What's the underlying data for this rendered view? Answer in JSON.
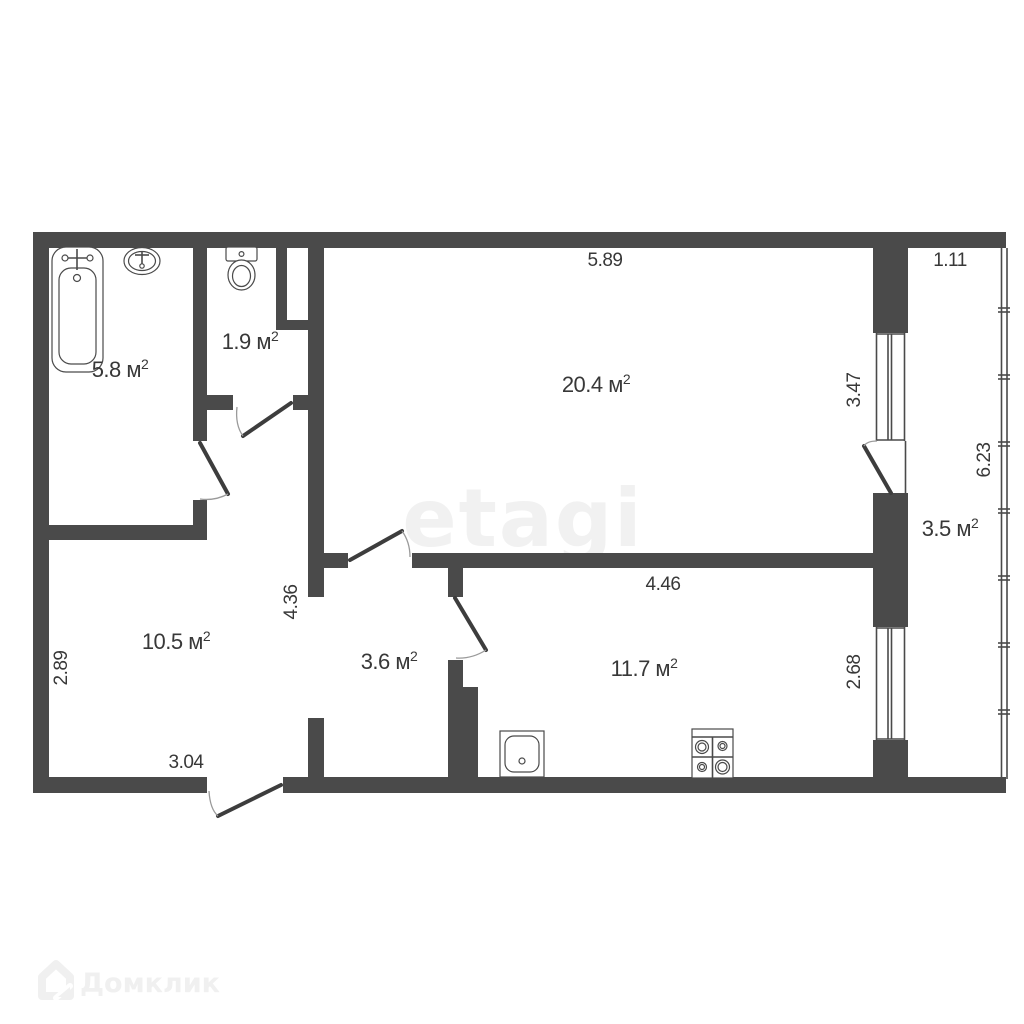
{
  "watermarks": {
    "brand_center": "etagi",
    "brand_bottom": "Домклик"
  },
  "rooms": [
    {
      "id": "bathroom",
      "area_label": "5.8 м",
      "sup": "2"
    },
    {
      "id": "toilet",
      "area_label": "1.9 м",
      "sup": "2"
    },
    {
      "id": "living-room",
      "area_label": "20.4 м",
      "sup": "2"
    },
    {
      "id": "loggia",
      "area_label": "3.5 м",
      "sup": "2"
    },
    {
      "id": "hallway",
      "area_label": "10.5 м",
      "sup": "2"
    },
    {
      "id": "corridor",
      "area_label": "3.6 м",
      "sup": "2"
    },
    {
      "id": "kitchen",
      "area_label": "11.7 м",
      "sup": "2"
    }
  ],
  "dimensions": {
    "living_top_width": "5.89",
    "loggia_top_width": "1.11",
    "living_window": "3.47",
    "loggia_length": "6.23",
    "kitchen_window": "2.68",
    "kitchen_width": "4.46",
    "hall_right_height": "4.36",
    "hall_left_height": "2.89",
    "hall_bottom_width": "3.04"
  },
  "icons": {
    "bathtub": "bathtub-icon",
    "sink": "sink-icon",
    "toilet": "toilet-icon",
    "kitchen_sink": "kitchen-sink-icon",
    "stove": "stove-icon",
    "house_logo": "house-logo-icon"
  },
  "colors": {
    "wall": "#4a4a4a",
    "text": "#383838",
    "watermark_center": "#f1f1f1",
    "watermark_bottom": "#f0f0f0",
    "background": "#ffffff"
  }
}
